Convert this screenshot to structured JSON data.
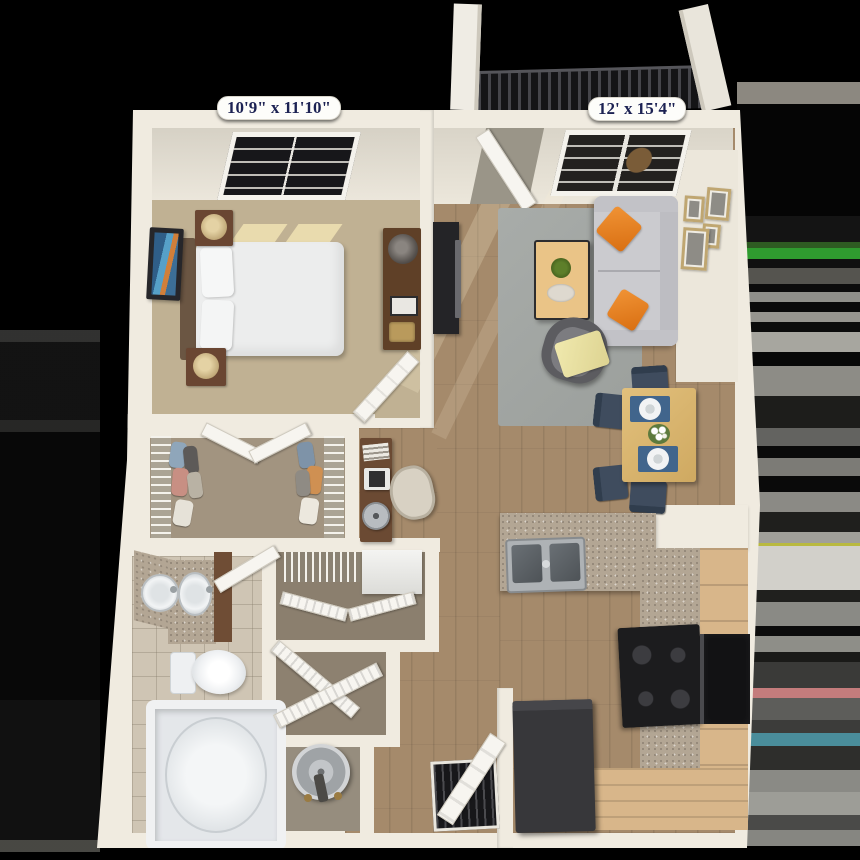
{
  "image_type": "3D apartment floor plan rendering, top-down view on black background",
  "labels": {
    "bedroom_dimensions": "10'9\" x 11'10\"",
    "living_room_dimensions": "12' x 15'4\""
  },
  "palette": {
    "background": "#000000",
    "wall_cream": "#f0ebe0",
    "label_text_navy": "#1c2253",
    "label_pill_white": "#fdfdfa",
    "bedroom_carpet": "#c0b193",
    "closet_carpet": "#a29480",
    "wood_floor": "#a58a6b",
    "area_rug_gray": "#a3a7a4",
    "sofa_gray": "#cbcbcf",
    "accent_orange": "#e8831f",
    "throw_yellow": "#ece5a4",
    "table_wood": "#d9b672",
    "dining_chair_blue": "#3f4c5e",
    "granite_counter": "#b3a694",
    "cabinet_wood": "#d8b68a",
    "appliance_black": "#1c1c1e",
    "fridge_dark": "#37373a",
    "bath_tile": "#cfc5b4",
    "fixture_white": "#f0f2f4",
    "balcony_rail_dark": "#141416"
  },
  "rooms": [
    {
      "name": "bedroom",
      "label": "10'9\" x 11'10\"",
      "items": [
        "window",
        "bed",
        "pillows",
        "nightstand-with-lamp",
        "nightstand-with-lamp",
        "wall-art",
        "dresser-with-lamp",
        "door"
      ]
    },
    {
      "name": "living-room",
      "label": "12' x 15'4\"",
      "items": [
        "balcony-door",
        "window",
        "tv-stand",
        "tv",
        "area-rug",
        "coffee-table-with-plant",
        "sofa",
        "orange-pillows",
        "accent-chair",
        "yellow-throw",
        "gallery-frames"
      ]
    },
    {
      "name": "dining-area",
      "items": [
        "dining-table",
        "placemats",
        "plates",
        "flower-centerpiece",
        "four-chairs"
      ]
    },
    {
      "name": "kitchen",
      "items": [
        "peninsula-counter",
        "double-sink",
        "stove",
        "oven",
        "cabinets",
        "refrigerator"
      ]
    },
    {
      "name": "walk-in-closet",
      "items": [
        "wire-shelving",
        "hanging-clothes",
        "double-doors"
      ]
    },
    {
      "name": "desk-nook",
      "items": [
        "desk",
        "laptop",
        "office-chair",
        "fan"
      ]
    },
    {
      "name": "bathroom",
      "items": [
        "double-vanity",
        "round-sink",
        "oval-sink",
        "toilet",
        "bathtub",
        "door"
      ]
    },
    {
      "name": "linen-closet",
      "items": [
        "wire-shelf",
        "stacked-appliance",
        "bifold-doors"
      ]
    },
    {
      "name": "storage-closet",
      "items": [
        "bifold-doors"
      ]
    },
    {
      "name": "utility-closet",
      "items": [
        "water-heater"
      ]
    },
    {
      "name": "balcony",
      "items": [
        "railing",
        "posts"
      ]
    }
  ]
}
